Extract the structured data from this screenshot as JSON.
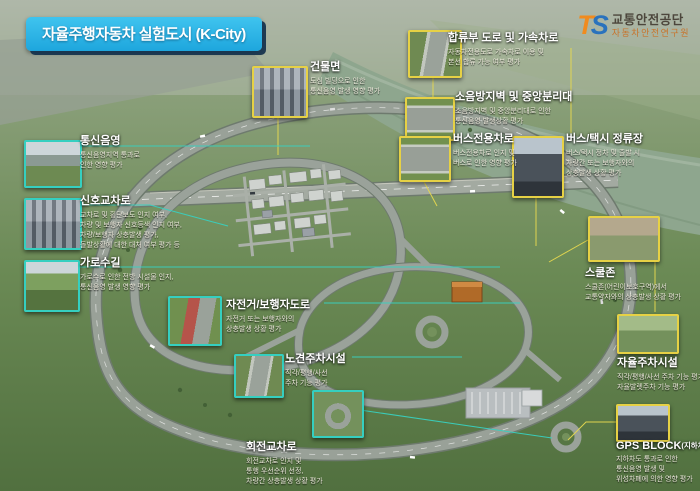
{
  "header": {
    "title_badge": "자율주행자동차 실험도시 (K-City)"
  },
  "logo": {
    "mark_t": "T",
    "mark_s": "S",
    "org": "교통안전공단",
    "org_sub": "자동차안전연구원"
  },
  "colors": {
    "badge_bg": "#2bb3e6",
    "badge_shadow": "#12304c",
    "callout_yellow": "#e6d145",
    "callout_teal": "#35cfc0",
    "grass": "#6b8a55",
    "road": "#99a198",
    "river": "#8fa78f"
  },
  "callouts": {
    "merge_road": {
      "title": "합류부 도로 및 가속차로",
      "lines": [
        "자동차전용도로 가속차로 이용 및",
        "본선 합류 가능 여부 평가"
      ]
    },
    "building": {
      "title": "건물면",
      "lines": [
        "도심 빌딩으로 인한",
        "통신음영 발생 영향 평가"
      ]
    },
    "noise_barrier": {
      "title": "소음방지벽 및 중앙분리대",
      "lines": [
        "소음방지벽 및 중앙분리대로 인한",
        "통신음영 발생상황 평가"
      ]
    },
    "bus_lane": {
      "title": "버스전용차로",
      "lines": [
        "버스전용차로 인지 및",
        "버스로 인한 영향 평가"
      ]
    },
    "bus_stop": {
      "title": "버스/택시 정류장",
      "lines": [
        "버스/택시 정차 및 출발 시",
        "차량간 또는 보행자와의",
        "상충발생 상황 평가"
      ]
    },
    "school_zone": {
      "title": "스쿨존",
      "lines": [
        "스쿨존(어린이보호구역)에서",
        "교통약자와의 상충발생 상황 평가"
      ]
    },
    "auto_parking": {
      "title": "자율주차시설",
      "lines": [
        "직각/평행/사선 주차 기능 평가,",
        "자율발렛주차 기능 평가"
      ]
    },
    "gps_block": {
      "title": "GPS BLOCK",
      "title_suffix": "(지하차도)",
      "lines": [
        "지하차도 통과로 인한",
        "통신음영 발생 및",
        "위성차폐에 의한 영향 평가"
      ]
    },
    "comm_shadow": {
      "title": "통신음영",
      "lines": [
        "통신음영지역 통과로",
        "인한 영향 평가"
      ]
    },
    "signal_intersection": {
      "title": "신호교차로",
      "lines": [
        "교차로 및 횡단보도 인지 여부,",
        "차량 및 보행자 신호등색 인지 여부,",
        "차량/보행자 상충발생 평가,",
        "돌발상황에 대한 대처 여부 평가 등"
      ]
    },
    "tree_street": {
      "title": "가로수길",
      "lines": [
        "가로수로 인한 전방 시설물 인지,",
        "통신음영 발생 영향 평가"
      ]
    },
    "bike_ped": {
      "title": "자전거/보행자도로",
      "lines": [
        "자전거 또는 보행자와의",
        "상충발생 상황 평가"
      ]
    },
    "roadside_parking": {
      "title": "노견주차시설",
      "lines": [
        "직각/평행/사선",
        "주차 기능 평가"
      ]
    },
    "roundabout": {
      "title": "회전교차로",
      "lines": [
        "회전교차로 인지 및",
        "통행 우선순위 선정,",
        "차량간 상충발생 상황 평가"
      ]
    }
  }
}
